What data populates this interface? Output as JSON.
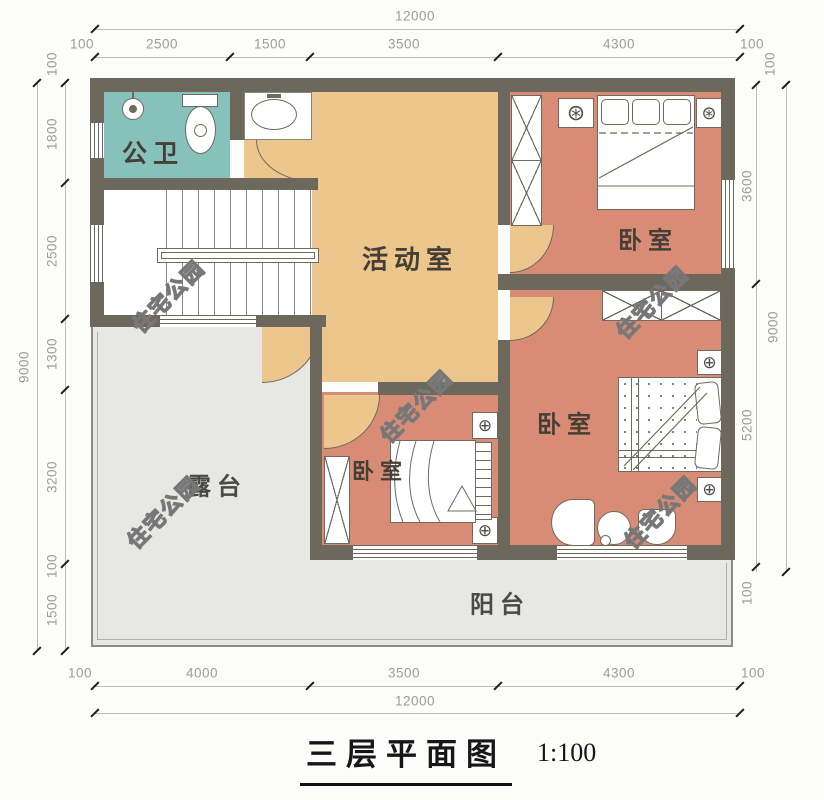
{
  "title": {
    "text": "三层平面图",
    "scale": "1:100"
  },
  "watermark": {
    "text": "住宅公园"
  },
  "rooms": {
    "bathroom": "公卫",
    "activity": "活动室",
    "bedroom_top": "卧室",
    "bedroom_right": "卧室",
    "bedroom_middle": "卧室",
    "terrace": "露台",
    "balcony": "阳台"
  },
  "icons": {
    "lamp_icon": "⊕",
    "fan_icon": "⊛"
  },
  "colors": {
    "wall": "#6c685b",
    "bathroom": "#86c1bb",
    "activity": "#ecc68c",
    "bedroom": "#d88c75",
    "outdoor": "#e7e7e4",
    "paper": "#fcfcfa",
    "dim_text": "#9c9c9a",
    "label_text": "#453f36"
  },
  "dims": {
    "top": {
      "total": "12000",
      "segments": [
        "100",
        "2500",
        "1500",
        "3500",
        "4300",
        "100"
      ]
    },
    "left": {
      "total": "9000",
      "segments": [
        "100",
        "1800",
        "2500",
        "1300",
        "3200",
        "100",
        "1500"
      ]
    },
    "right": {
      "total": "9000",
      "segments": [
        "100",
        "3600",
        "5200",
        "100"
      ]
    },
    "bottom": {
      "total": "12000",
      "segments": [
        "100",
        "4000",
        "3500",
        "4300",
        "100"
      ]
    }
  }
}
